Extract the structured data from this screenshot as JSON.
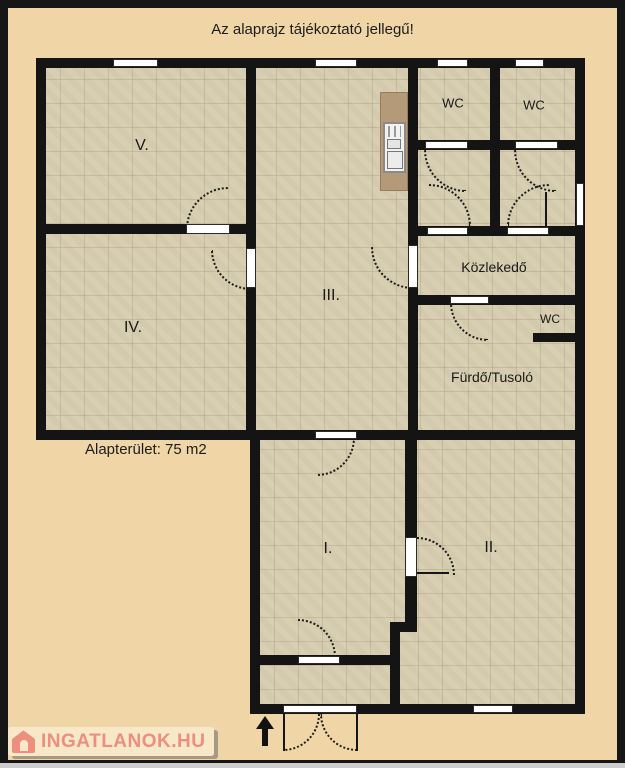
{
  "title": "Az alaprajz tájékoztató jellegű!",
  "area_label": "Alapterület: 75 m2",
  "rooms": [
    {
      "id": "room-v",
      "label": "V."
    },
    {
      "id": "room-iv",
      "label": "IV."
    },
    {
      "id": "room-iii",
      "label": "III."
    },
    {
      "id": "room-i",
      "label": "I."
    },
    {
      "id": "room-ii",
      "label": "II."
    },
    {
      "id": "wc-top-left",
      "label": "WC"
    },
    {
      "id": "wc-top-right",
      "label": "WC"
    },
    {
      "id": "kozlekedo",
      "label": "Közlekedő"
    },
    {
      "id": "wc-bathroom",
      "label": "WC"
    },
    {
      "id": "furdo-tusolo",
      "label": "Fürdő/Tusoló"
    }
  ],
  "watermark": {
    "text": "INGATLANOK.HU",
    "icon": "house-icon"
  },
  "icons": {
    "entrance_arrow": "up-arrow",
    "watermark_logo": "house-icon"
  },
  "colors": {
    "bg": "#f0d6a6",
    "floor": "#d8cfb2",
    "wall": "#141414",
    "counter": "#b49a78",
    "accent": "#ec8f7f"
  }
}
